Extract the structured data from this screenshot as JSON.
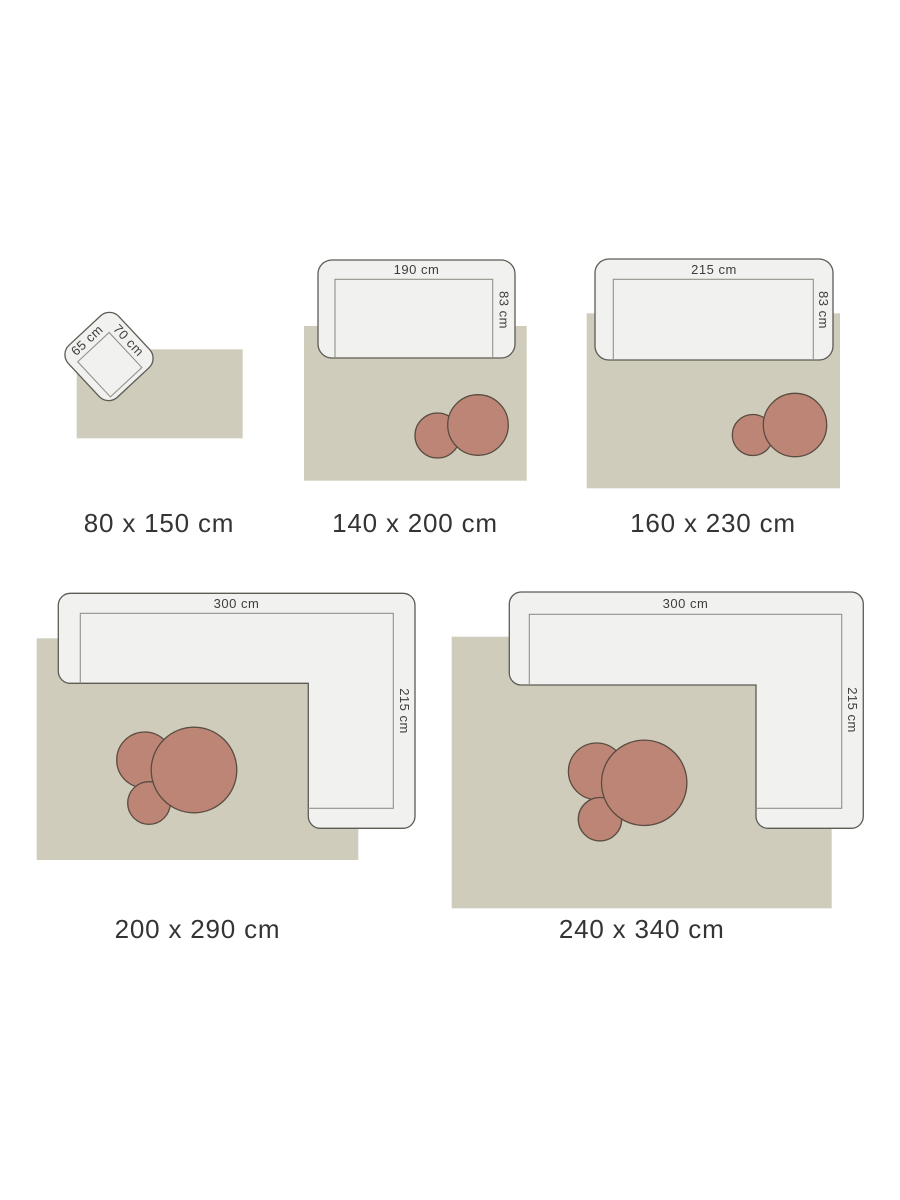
{
  "title": "Rug size guide (top-view room layouts)",
  "colors": {
    "page_background": "#ffffff",
    "rug": "#cfccbb",
    "sofa_fill": "#f1f1ef",
    "sofa_border": "#5c5b54",
    "seat_inner_line": "#94928a",
    "table_fill": "#bc8576",
    "table_border": "#5a4c41",
    "dimension_text": "#3d3d3b",
    "size_label_text": "#343434"
  },
  "diagrams": [
    {
      "name": "rug-80x150",
      "rug_size_label": "80 x 150 cm",
      "furniture": "armchair",
      "dims": {
        "width": "65 cm",
        "depth": "70 cm"
      }
    },
    {
      "name": "rug-140x200",
      "rug_size_label": "140 x 200 cm",
      "furniture": "sofa with two round side tables",
      "dims": {
        "width": "190 cm",
        "depth": "83 cm"
      }
    },
    {
      "name": "rug-160x230",
      "rug_size_label": "160 x 230 cm",
      "furniture": "sofa with two round side tables",
      "dims": {
        "width": "215 cm",
        "depth": "83 cm"
      }
    },
    {
      "name": "rug-200x290",
      "rug_size_label": "200 x 290 cm",
      "furniture": "corner sofa with three round tables",
      "dims": {
        "width": "300 cm",
        "depth": "215 cm"
      }
    },
    {
      "name": "rug-240x340",
      "rug_size_label": "240 x 340 cm",
      "furniture": "corner sofa with three round tables",
      "dims": {
        "width": "300 cm",
        "depth": "215 cm"
      }
    }
  ]
}
